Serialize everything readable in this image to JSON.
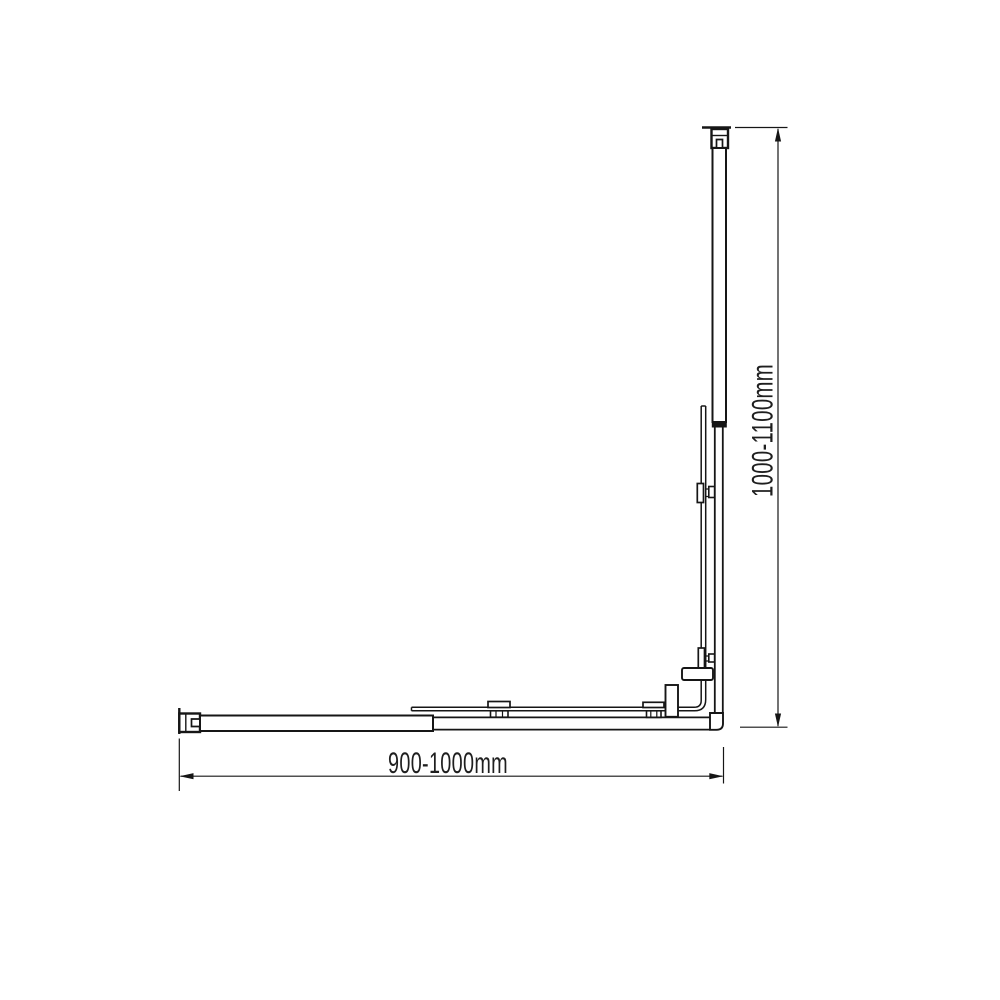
{
  "canvas": {
    "background": "#ffffff",
    "line_color": "#161616",
    "text_color": "#1f1f1f"
  },
  "diagram": {
    "type": "technical-drawing",
    "dimensions": {
      "width_label": "900-1000mm",
      "height_label": "1000-1100mm"
    }
  }
}
